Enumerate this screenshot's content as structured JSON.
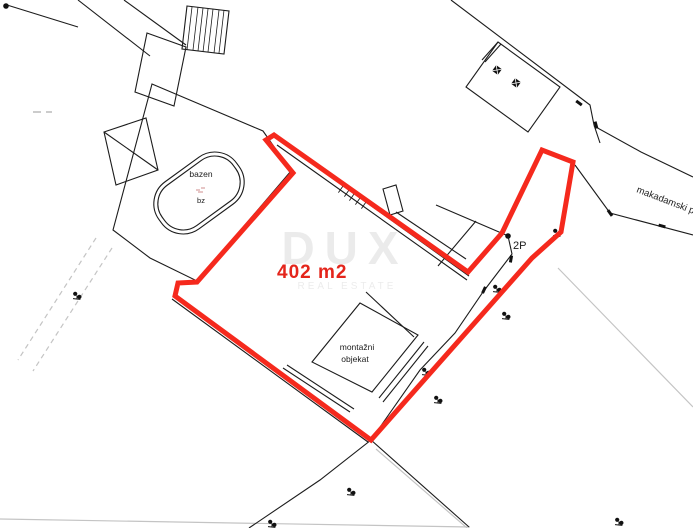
{
  "map": {
    "area_label": "402 m2",
    "pool_label": "bazen",
    "pool_code": "bz",
    "prefab_label_line1": "montažni",
    "prefab_label_line2": "objekat",
    "road_label": "makadamski put",
    "survey_point_label": "2P",
    "watermark_title": "DUX",
    "watermark_subtitle": "REAL ESTATE",
    "colors": {
      "plot_outline": "#f5291d",
      "area_text": "#e4251b",
      "map_line": "#1c1c1c",
      "faint_line": "#c4c4c4"
    }
  }
}
